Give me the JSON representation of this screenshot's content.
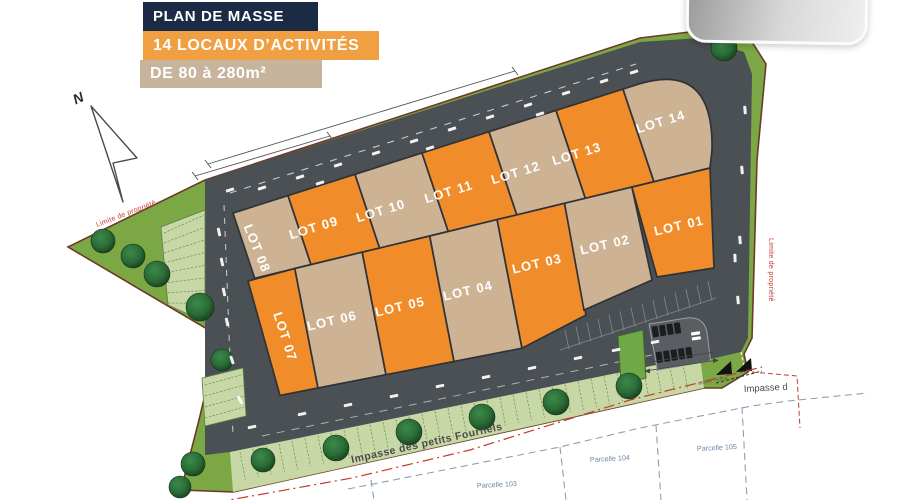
{
  "header": {
    "title": "PLAN DE MASSE",
    "subtitle": "14 LOCAUX D’ACTIVITÉS",
    "size_range": "DE 80 à 280m²"
  },
  "compass": {
    "north_label": "N"
  },
  "boundary": {
    "label_left": "Limite de propriété",
    "label_right": "Limite de propriété"
  },
  "streets": {
    "bottom_street": "Impasse des petits Fournels",
    "right_street": "Impasse d",
    "entrance_label": "entrée - sortie"
  },
  "parcels": [
    {
      "label": "Parcelle 103"
    },
    {
      "label": "Parcelle 104"
    },
    {
      "label": "Parcelle 105"
    }
  ],
  "lots": {
    "top_row": [
      {
        "id": "lot-08",
        "label": "LOT 08",
        "color": "tan"
      },
      {
        "id": "lot-09",
        "label": "LOT 09",
        "color": "orange"
      },
      {
        "id": "lot-10",
        "label": "LOT 10",
        "color": "tan"
      },
      {
        "id": "lot-11",
        "label": "LOT 11",
        "color": "orange"
      },
      {
        "id": "lot-12",
        "label": "LOT 12",
        "color": "tan"
      },
      {
        "id": "lot-13",
        "label": "LOT 13",
        "color": "orange"
      },
      {
        "id": "lot-14",
        "label": "LOT 14",
        "color": "tan"
      }
    ],
    "bottom_row": [
      {
        "id": "lot-07",
        "label": "LOT 07",
        "color": "orange"
      },
      {
        "id": "lot-06",
        "label": "LOT 06",
        "color": "tan"
      },
      {
        "id": "lot-05",
        "label": "LOT 05",
        "color": "orange"
      },
      {
        "id": "lot-04",
        "label": "LOT 04",
        "color": "tan"
      },
      {
        "id": "lot-03",
        "label": "LOT 03",
        "color": "orange"
      },
      {
        "id": "lot-02",
        "label": "LOT 02",
        "color": "tan"
      },
      {
        "id": "lot-01",
        "label": "LOT 01",
        "color": "orange"
      }
    ]
  },
  "colors": {
    "navy": "#1C2B45",
    "header_orange": "#F0A042",
    "header_tan": "#C6B59C",
    "lot_orange": "#F08C29",
    "lot_tan": "#CDB394",
    "road": "#4B5054",
    "grass": "#7BA844",
    "bays_green": "#C7D8A6",
    "bay_line": "#6E8F54",
    "island_green": "#6FA845",
    "tree_dark": "#173F1F",
    "boundary_brown": "#6E3A26",
    "red": "#C23A2B",
    "parcel_blue": "#8BA0B6",
    "parcel_text": "#6E88AA",
    "street_text": "#4A4A4A",
    "logo_gray_dark": "#9A9A9A",
    "logo_gray_light": "#EFEFEF",
    "white": "#FFFFFF"
  }
}
